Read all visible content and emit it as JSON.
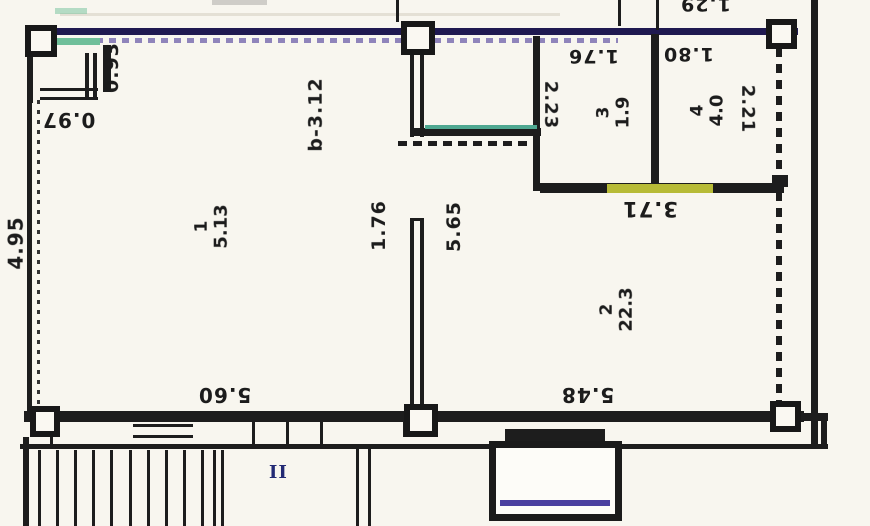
{
  "plan": {
    "dimensions": {
      "v097": "0.97",
      "v093": "0.93",
      "v495": "4.95",
      "vb312": "b-3.12",
      "v223": "2.23",
      "v176top": "1.76",
      "v180": "1.80",
      "v129": "1.29",
      "v221": "2.21",
      "v371": "3.71",
      "v176mid": "1.76",
      "v565": "5.65",
      "v560": "5.60",
      "v548": "5.48"
    },
    "rooms": [
      {
        "number": "1",
        "area": "5.13"
      },
      {
        "number": "2",
        "area": "22.3"
      },
      {
        "number": "3",
        "area": "1.9"
      },
      {
        "number": "4",
        "area": "4.0"
      }
    ],
    "stairwell_label": "II"
  },
  "colors": {
    "wall": "#1d1d1d",
    "top_wall_navy": "#1f1950",
    "highlight_yellow": "#d2d73c",
    "teal_line": "#4fa891",
    "purple_dash": "#8f84bb",
    "stoop_purple": "#4a3f9f",
    "stair_label_navy": "#232a74",
    "background": "#f8f6ef"
  }
}
